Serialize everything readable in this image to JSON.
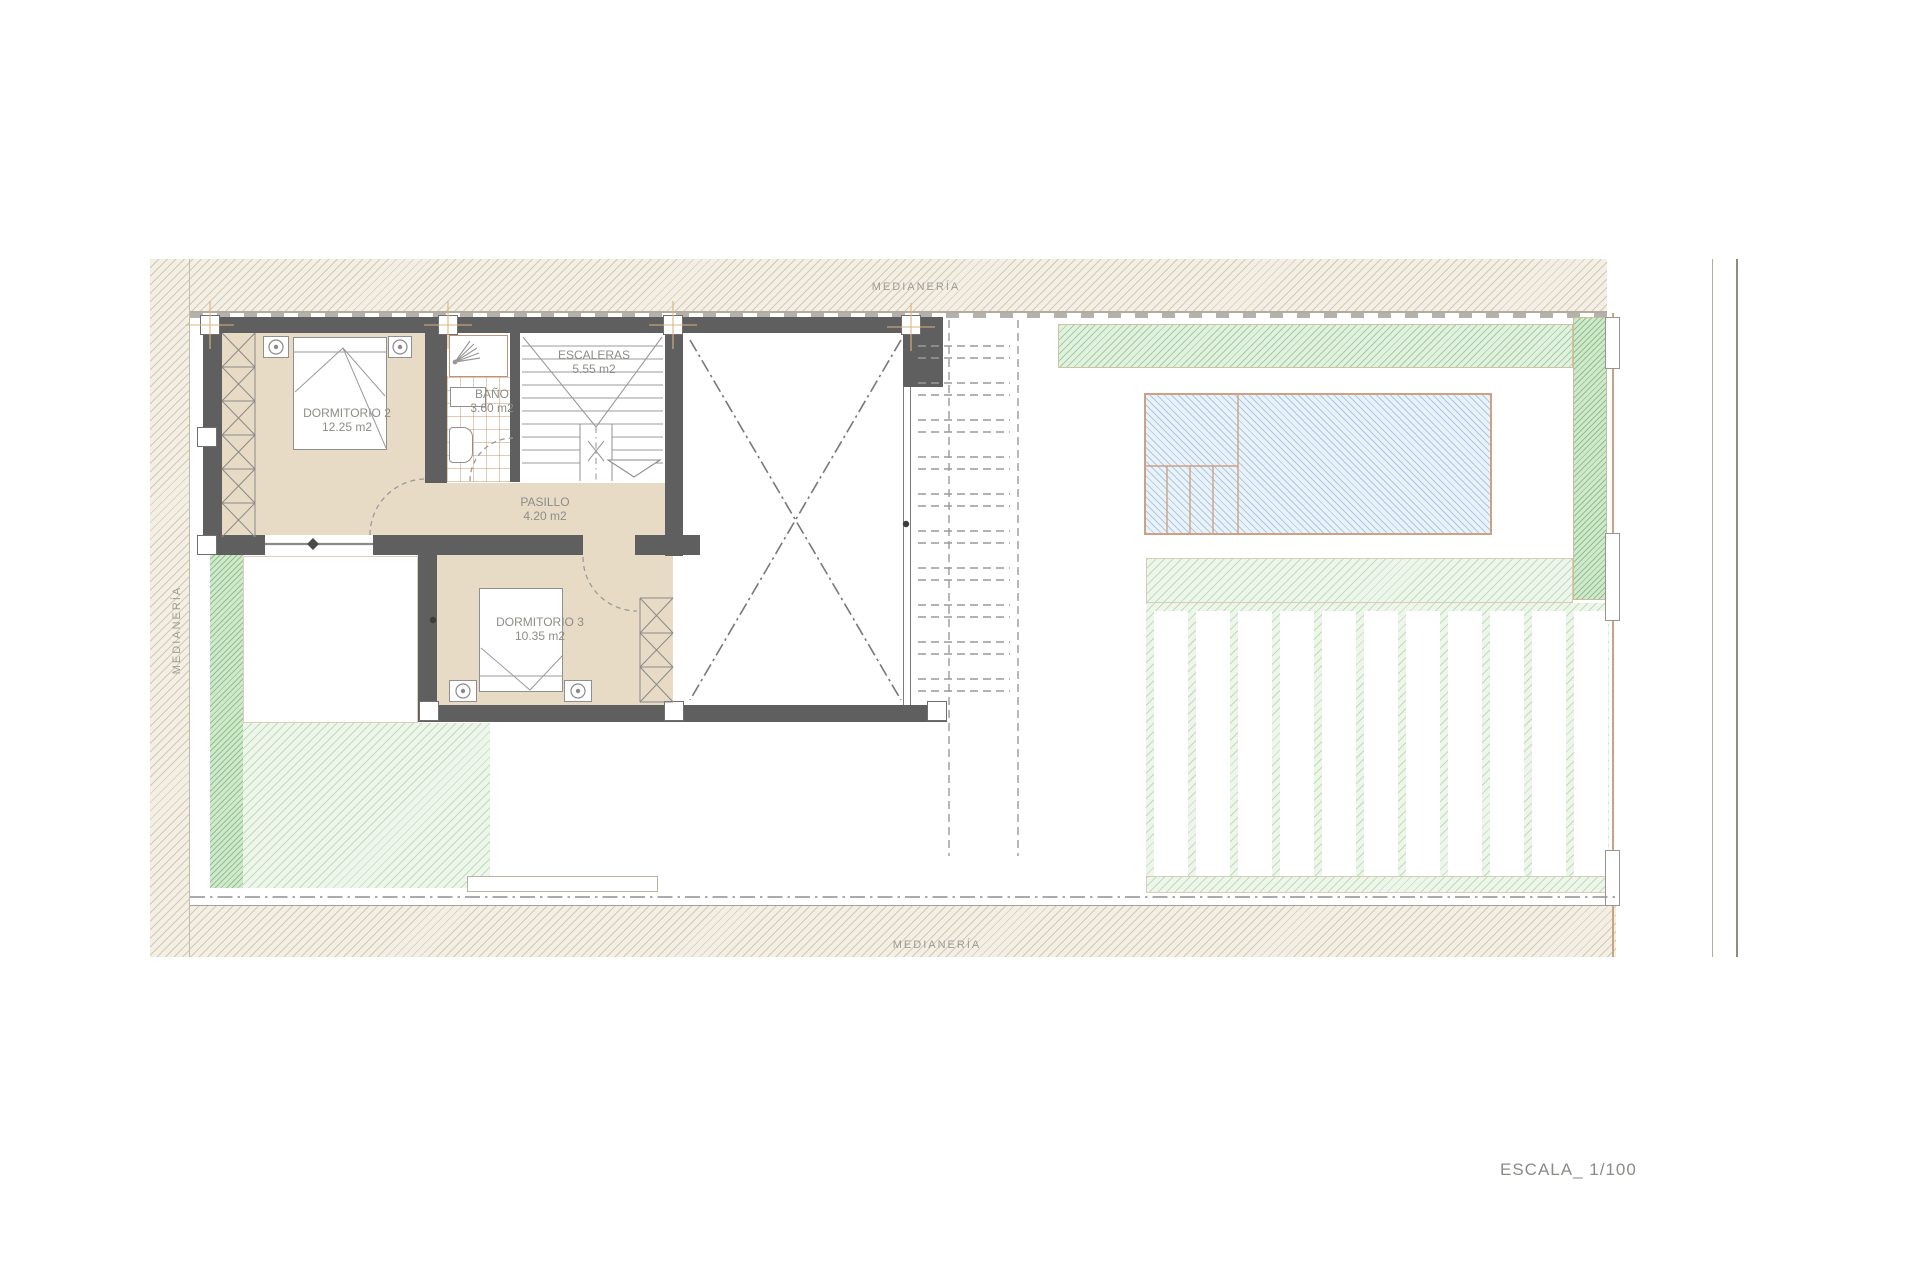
{
  "document": {
    "scale_label": "ESCALA_ 1/100",
    "party_wall_label": "MEDIANERÍA"
  },
  "rooms": [
    {
      "name": "DORMITORIO 2",
      "area": "12.25 m2"
    },
    {
      "name": "BAÑO",
      "area": "3.60 m2"
    },
    {
      "name": "ESCALERAS",
      "area": "5.55 m2"
    },
    {
      "name": "PASILLO",
      "area": "4.20 m2"
    },
    {
      "name": "DORMITORIO 3",
      "area": "10.35 m2"
    }
  ],
  "colors": {
    "wall": "#5f5f5f",
    "room_fill": "#e7dbc5",
    "pool_fill": "#e9f2f9",
    "pool_hatch": "#6ea0cd",
    "pool_edge": "#cfa184",
    "garden_green": "#cfe8cc",
    "band_hatch": "#a69270",
    "label_text": "#8d8d88"
  }
}
